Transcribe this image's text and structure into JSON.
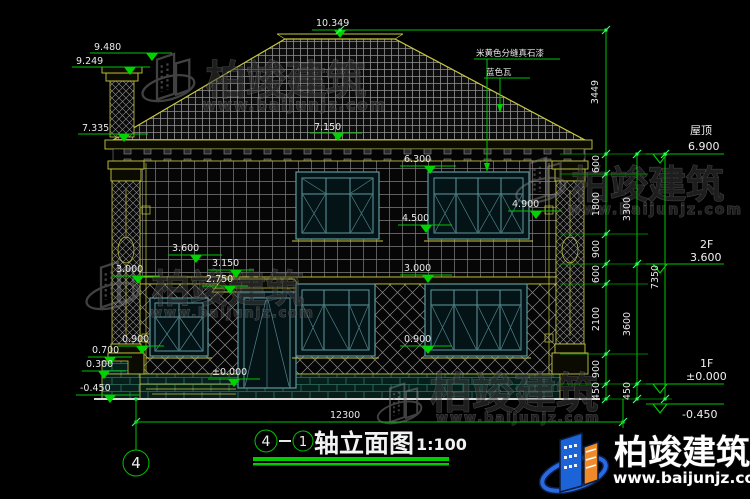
{
  "titlebar": {
    "axis_a": "4",
    "axis_b": "1",
    "text": "轴立面图",
    "scale": "1:100"
  },
  "axes": {
    "a4": "4"
  },
  "notes": {
    "wall": "米黄色分缝真石漆",
    "tile": "蓝色瓦"
  },
  "levels": {
    "ridge": "10.349",
    "chimney_top": "9.480",
    "chimney_cap": "9.249",
    "eave_soffit": "7.335",
    "eave_top": "7.150",
    "roof_name": "屋顶",
    "roof": "6.900",
    "w2_head": "6.300",
    "w2_sill": "4.500",
    "w2_sill_r": "4.900",
    "f2_name": "2F",
    "f2": "3.600",
    "f1_head_l": "3.000",
    "f1_head": "3.000",
    "canopy_top": "3.150",
    "canopy_btm": "2.750",
    "f1_sill_l": "0.900",
    "f1_sill": "0.900",
    "porch_top": "0.700",
    "plinth_top": "0.300",
    "f1_name": "1F",
    "zero": "±0.000",
    "zero_door": "±0.000",
    "ground": "-0.450",
    "ground_l": "-0.450"
  },
  "dims": {
    "total": "12300",
    "col1": [
      "3449",
      "600",
      "1800",
      "900",
      "600",
      "2100",
      "900",
      "450"
    ],
    "col2": [
      "3300",
      "3600",
      "450"
    ],
    "col3": [
      "7350"
    ]
  },
  "brand": {
    "name": "柏竣建筑",
    "site": "www.baijunjz.com"
  },
  "colors": {
    "dim_green": "#00c400",
    "cad_yellow": "#c9c93e",
    "window_teal": "#5e98a0",
    "logo_blue": "#1d63d8",
    "logo_orange": "#f08a28"
  }
}
